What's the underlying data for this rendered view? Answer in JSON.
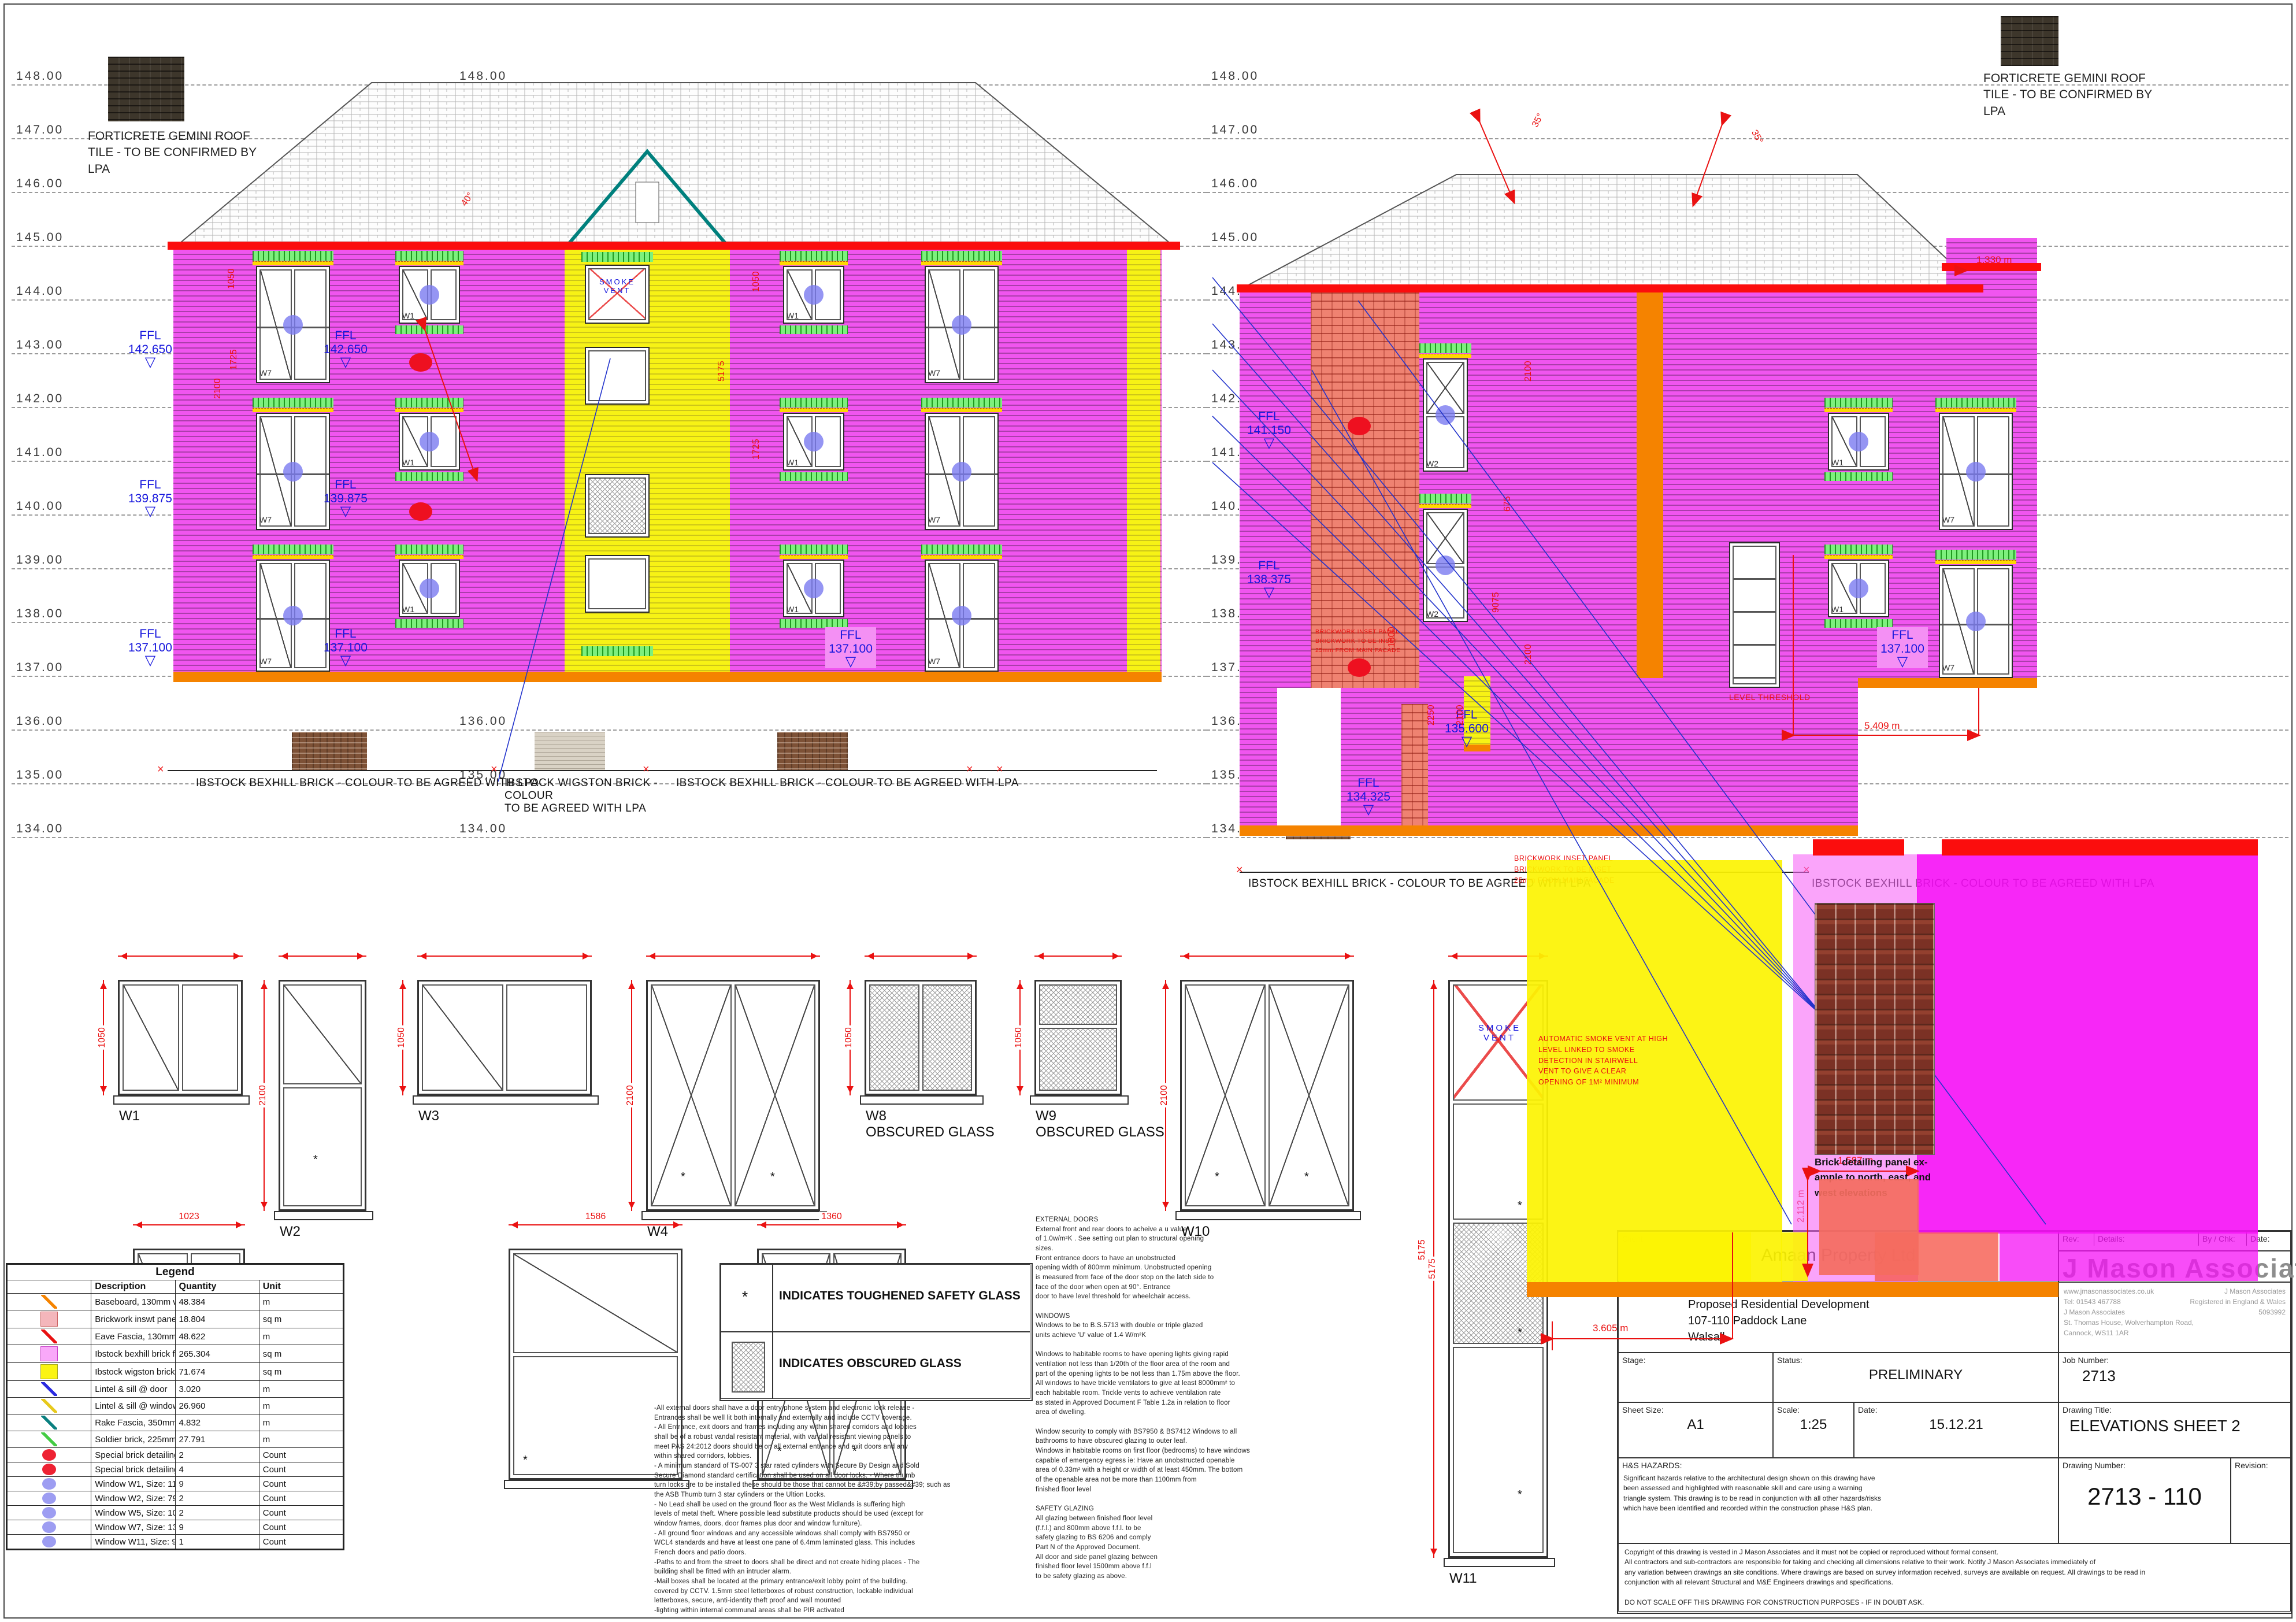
{
  "levels": [
    "148.00",
    "147.00",
    "146.00",
    "145.00",
    "144.00",
    "143.00",
    "142.00",
    "141.00",
    "140.00",
    "139.00",
    "138.00",
    "137.00",
    "136.00",
    "135.00",
    "134.00"
  ],
  "drawing": {
    "roof_note": "FORTICRETE GEMINI ROOF\nTILE - TO BE CONFIRMED BY\nLPA",
    "bexhill_label": "IBSTOCK BEXHILL BRICK - COLOUR TO BE AGREED WITH LPA",
    "wigston_label": "IBSTOCK WIGSTON BRICK -\nCOLOUR\nTO BE AGREED WITH LPA",
    "inset_note": "BRICKWORK INSET PANEL\nBRICKWORK TO BE INSET\n25mm FROM MAIN FACADE",
    "smoke_vent_label": "SMOKE\nVENT",
    "smoke_vent_note": "AUTOMATIC SMOKE VENT AT HIGH\nLEVEL LINKED TO SMOKE\nDETECTION IN STAIRWELL\nVENT TO GIVE A CLEAR\nOPENING OF 1M² MINIMUM",
    "level_threshold": "LEVEL THRESHOLD",
    "brick_panel_caption": "Brick detailing panel ex-\nample to north, east, and\nwest elevations",
    "window_tags": {
      "w1": "W1",
      "w2": "W2",
      "w7": "W7"
    }
  },
  "ffl": {
    "prefix": "FFL",
    "values": [
      "142.650",
      "139.875",
      "137.100",
      "141.150",
      "138.375",
      "135.600",
      "134.325"
    ]
  },
  "dimensions": {
    "rotated": [
      "2100",
      "1050",
      "1725",
      "5175",
      "1050",
      "1725",
      "2100",
      "675",
      "2100",
      "9075",
      "2250",
      "2100",
      "1800",
      "40°",
      "35°",
      "35°",
      "2.112 m",
      "5175"
    ],
    "m3605": "3.605 m",
    "m1330": "1.330 m",
    "m1587": "1.587 m",
    "m5409": "5.409 m",
    "schedule_top": [
      "1135",
      "798",
      "1586",
      "1585",
      "1022",
      "797",
      "1586",
      "910"
    ],
    "schedule_vert": [
      "1050",
      "2100",
      "1050",
      "2100",
      "1050",
      "1050",
      "2100",
      "5175"
    ],
    "schedule_bottom": [
      "1023",
      "1586",
      "1360"
    ]
  },
  "window_schedule": {
    "items": [
      {
        "id": "W1",
        "note": ""
      },
      {
        "id": "W2",
        "note": ""
      },
      {
        "id": "W3",
        "note": ""
      },
      {
        "id": "W4",
        "note": ""
      },
      {
        "id": "W8",
        "note": "OBSCURED GLASS"
      },
      {
        "id": "W9",
        "note": "OBSCURED GLASS"
      },
      {
        "id": "W10",
        "note": ""
      },
      {
        "id": "W11",
        "note": ""
      }
    ]
  },
  "key": {
    "symbol": "*",
    "toughened": "INDICATES TOUGHENED SAFETY GLASS",
    "obscured": "INDICATES OBSCURED GLASS"
  },
  "notes": {
    "security": "-All external doors shall have a door entry phone system and electronic lock release -\nEntrances shall be well lit both internally and externally and include CCTV coverage.\n- All Entrance, exit doors and frames including any within shared corridors and lobbies\nshall be of a robust vandal resistant material, with vandal resistant viewing panels to\nmeet PAS 24:2012 doors should be on all external entrance and exit doors and any\nwithin shared corridors, lobbies.\n- A minimum standard of TS-007 3 star rated cylinders with Secure By Design and Sold\nSecure Diamond standard certification shall be used on all door locks. - Where thumb\nturn locks are to be installed these should be those that cannot be &#39;by passed&#39; such as\nthe ASB Thumb turn 3 star cylinders or the Ultion Locks.\n- No Lead shall be used on the ground floor as the West Midlands is suffering high\nlevels of metal theft. Where possible lead substitute products should be used (except for\nwindow frames, doors, door frames plus door and window furniture).\n- All ground floor windows and any accessible windows shall comply with BS7950 or\nWCL4 standards and have at least one pane of 6.4mm laminated glass. This includes\nFrench doors and patio doors.\n-Paths to and from the street to doors shall be direct and not create hiding places - The\nbuilding shall be fitted with an intruder alarm.\n-Mail boxes shall be located at the primary entrance/exit lobby point of the building.\ncovered by CCTV. 1.5mm steel letterboxes of robust construction, lockable individual\nletterboxes, secure, anti-identity theft proof and wall mounted\n-lighting within internal communal areas shall be PIR activated",
    "doors_windows": "EXTERNAL DOORS\nExternal front and rear doors to acheive a u value\nof 1.0w/m²K . See setting out plan to structural opening\nsizes.\nFront entrance doors to have an unobstructed\nopening width of 800mm minimum. Unobstructed opening\nis measured from face of the door stop on the latch side to\nface of the door when open at 90°. Entrance\ndoor to have level threshold for wheelchair access.\n\nWINDOWS\nWindows to be to B.S.5713 with double or triple glazed\nunits achieve 'U' value of 1.4 W/m²K\n\nWindows to habitable rooms to have opening lights giving rapid\nventilation not less than 1/20th of the floor area of the room and\npart of the opening lights to be not less than 1.75m above the floor.\nAll windows to have trickle ventilators to give at least 8000mm² to\neach habitable room. Trickle vents to achieve ventilation rate\nas stated in Approved Document F Table 1.2a in relation to floor\narea of dwelling.\n\nWindow security to comply with BS7950 & BS7412 Windows to all\nbathrooms to have obscured glazing to outer leaf.\nWindows in habitable rooms on first floor (bedrooms) to have windows\ncapable of emergency egress ie: Have an unobstructed openable\narea of 0.33m² with a height or width of at least 450mm. The bottom\nof the openable area not be more than 1100mm from\nfinished floor level\n\nSAFETY GLAZING\nAll glazing between finished floor level\n(f.f.l.) and 800mm above f.f.l. to be\nsafety glazing to BS 6206 and comply\nPart N of the Approved Document.\nAll door and side panel glazing between\nfinished floor level 1500mm above f.f.l\nto be safety glazing as above."
  },
  "legend": {
    "title": "Legend",
    "headers": {
      "description": "Description",
      "quantity": "Quantity",
      "unit": "Unit"
    },
    "rows": [
      {
        "swatch": "line-orange",
        "description": "Baseboard, 130mm wide",
        "quantity": "48.384",
        "unit": "m"
      },
      {
        "swatch": "fill-pink",
        "description": "Brickwork inswt panel - Brickwork to be inset 25mm from main facade",
        "quantity": "18.804",
        "unit": "sq m"
      },
      {
        "swatch": "line-red",
        "description": "Eave Fascia, 130mm wide",
        "quantity": "48.622",
        "unit": "m"
      },
      {
        "swatch": "fill-magenta",
        "description": "Ibstock bexhill brick finish @ exterior",
        "quantity": "265.304",
        "unit": "sq m"
      },
      {
        "swatch": "fill-yellow",
        "description": "Ibstock wigston brick finish @ exterior",
        "quantity": "71.674",
        "unit": "sq m"
      },
      {
        "swatch": "line-blue",
        "description": "Lintel & sill @ door",
        "quantity": "3.020",
        "unit": "m"
      },
      {
        "swatch": "line-gold",
        "description": "Lintel & sill @ window",
        "quantity": "26.960",
        "unit": "m"
      },
      {
        "swatch": "line-teal",
        "description": "Rake Fascia,  350mm wide",
        "quantity": "4.832",
        "unit": "m"
      },
      {
        "swatch": "line-green",
        "description": "Soldier brick, 225mm wide",
        "quantity": "27.791",
        "unit": "m"
      },
      {
        "swatch": "dot-red",
        "description": "Special brick detailing panel (Location) ,  2m x 2m",
        "quantity": "2",
        "unit": "Count"
      },
      {
        "swatch": "dot-red",
        "description": "Special brick detailing panel (Location) , 1m x 1.1m",
        "quantity": "4",
        "unit": "Count"
      },
      {
        "swatch": "dot-purple",
        "description": "Window W1,  Size: 1135mm x 1050mm",
        "quantity": "9",
        "unit": "Count"
      },
      {
        "swatch": "dot-purple",
        "description": "Window W2,  Size: 798mm x 2100mm",
        "quantity": "2",
        "unit": "Count"
      },
      {
        "swatch": "dot-purple",
        "description": "Window W5, Size: 1023mm x 1200mm",
        "quantity": "2",
        "unit": "Count"
      },
      {
        "swatch": "dot-purple",
        "description": "Window W7, Size: 1360mm x 2100mm",
        "quantity": "9",
        "unit": "Count"
      },
      {
        "swatch": "dot-purple",
        "description": "Window W11,  Size: 910mm x 5175mm",
        "quantity": "1",
        "unit": "Count"
      }
    ]
  },
  "title_block": {
    "client_label": "Client:",
    "client": "Amaan Property Ltd",
    "project_label": "Project:",
    "project": "Proposed Residential Development\n107-110 Paddock Lane\nWalsall",
    "stage_label": "Stage:",
    "status_label": "Status:",
    "status": "PRELIMINARY",
    "job_label": "Job Number:",
    "job": "2713",
    "sheet_size_label": "Sheet Size:",
    "sheet_size": "A1",
    "scale_label": "Scale:",
    "scale": "1:25",
    "date_label": "Date:",
    "date": "15.12.21",
    "title_label": "Drawing Title:",
    "drawing_title": "ELEVATIONS SHEET 2",
    "hs_label": "H&S HAZARDS:",
    "hs_text": "Significant hazards relative to the architectural design shown on this drawing have\nbeen assessed and highlighted with reasonable skill and care using a warning\ntriangle system. This drawing is to be read in conjunction with all other hazards/risks\nwhich have been identified and recorded within the construction phase H&S plan.",
    "number_label": "Drawing Number:",
    "number": "2713 - 110",
    "revision_label": "Revision:",
    "rev_label": "Rev:",
    "details_label": "Details:",
    "bychk_label": "By / Chk:",
    "date2_label": "Date:",
    "logo": "J Mason Associates",
    "contact": "www.jmasonassociates.co.uk\nTel: 01543 467788\nJ Mason Associates\nSt. Thomas House, Wolverhampton Road,\nCannock, WS11 1AR",
    "registered": "J Mason Associates\nRegistered in England & Wales\n5093992",
    "copyright": "Copyright of this drawing is vested in J Mason Associates and it must not be copied or reproduced without formal consent.\nAll contractors and sub-contractors are responsible for taking and checking all dimensions relative to their work. Notify J Mason Associates immediately of\nany variation between drawings an site conditions. Where drawings are based on survey information received, surveys are available on request. All drawings to be read in\nconjunction with all relevant Structural and M&E Engineers drawings and specifications.\n\nDO NOT SCALE OFF THIS DRAWING FOR CONSTRUCTION PURPOSES - IF IN DOUBT ASK."
  }
}
